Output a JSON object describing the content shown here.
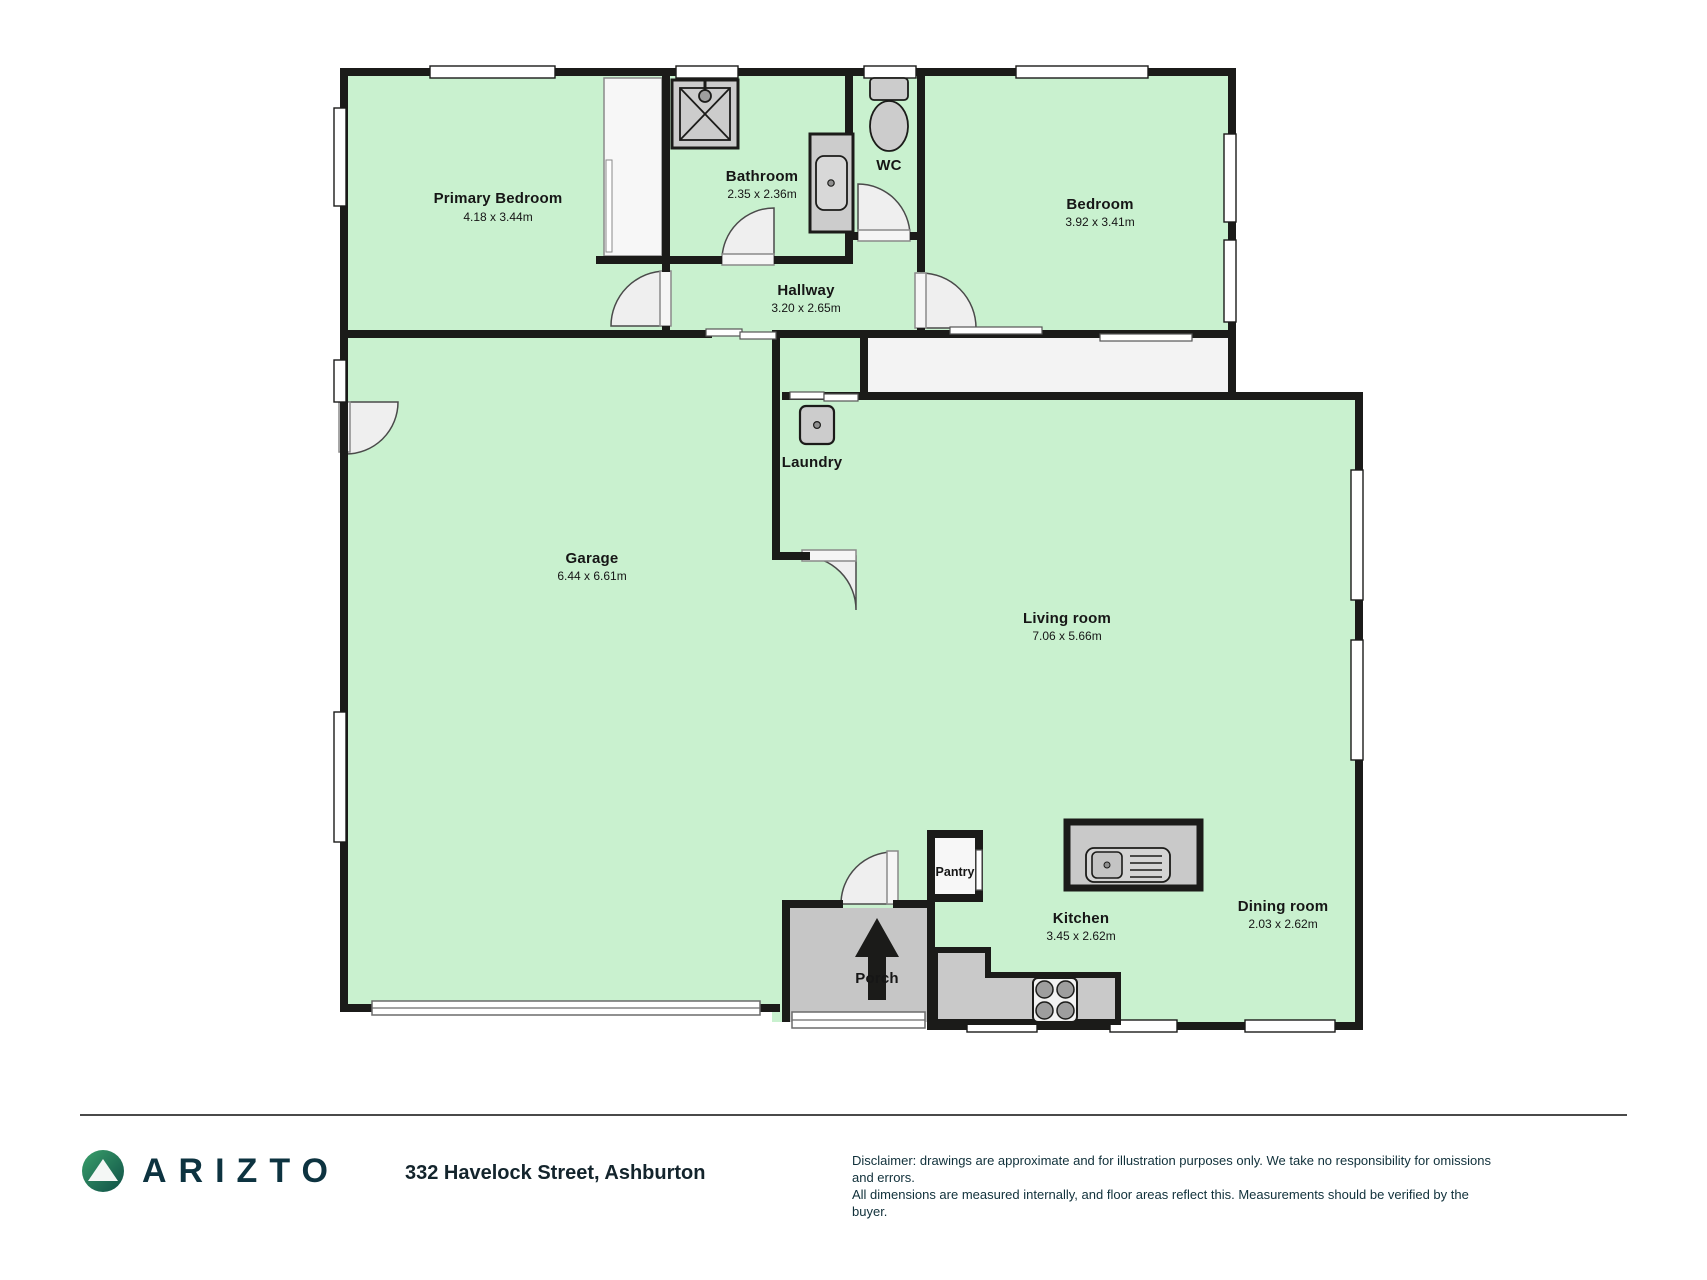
{
  "brand": {
    "name": "ARIZTO"
  },
  "address": "332 Havelock Street, Ashburton",
  "disclaimer": {
    "line1": "Disclaimer: drawings are approximate and for illustration purposes only. We take no responsibility for omissions and errors.",
    "line2": "All dimensions are measured internally, and floor areas reflect this. Measurements should be verified by the buyer."
  },
  "rooms": [
    {
      "name": "Primary Bedroom",
      "dims": "4.18 x 3.44m"
    },
    {
      "name": "Bathroom",
      "dims": "2.35 x 2.36m"
    },
    {
      "name": "WC",
      "dims": ""
    },
    {
      "name": "Bedroom",
      "dims": "3.92 x 3.41m"
    },
    {
      "name": "Hallway",
      "dims": "3.20 x 2.65m"
    },
    {
      "name": "Garage",
      "dims": "6.44 x 6.61m"
    },
    {
      "name": "Laundry",
      "dims": ""
    },
    {
      "name": "Living room",
      "dims": "7.06 x 5.66m"
    },
    {
      "name": "Pantry",
      "dims": ""
    },
    {
      "name": "Kitchen",
      "dims": "3.45 x 2.62m"
    },
    {
      "name": "Dining room",
      "dims": "2.03 x 2.62m"
    },
    {
      "name": "Porch",
      "dims": ""
    }
  ],
  "fixtures": [
    "shower",
    "vanity-sink",
    "toilet",
    "laundry-tub",
    "island-sink",
    "stove",
    "entry-arrow",
    "wardrobe",
    "garage-door",
    "pantry-slider"
  ],
  "colors": {
    "floor_green": "#c9f1cf",
    "wall": "#1b1b19",
    "fixture_gray": "#cccccc",
    "porch_gray": "#c6c6c6",
    "door_leaf": "#efefef",
    "logo_gradient_start": "#3aa06b",
    "logo_gradient_end": "#0f4f46",
    "brand_text": "#0d3340",
    "label_text": "#161616"
  }
}
